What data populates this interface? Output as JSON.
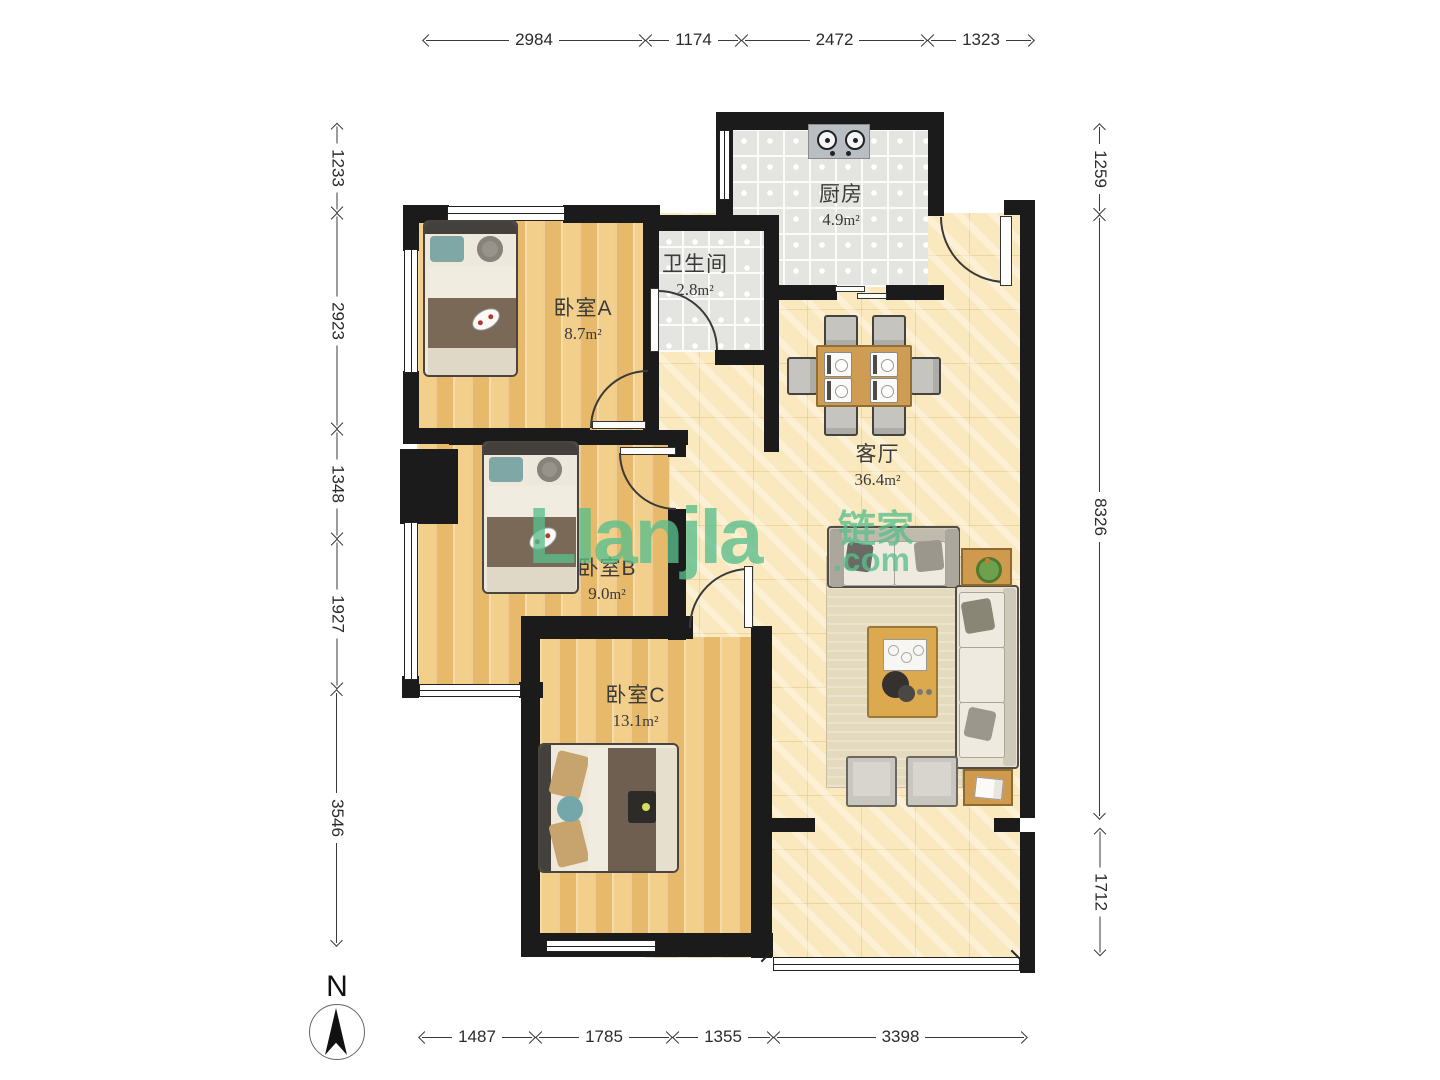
{
  "title": "户型图",
  "rooms": [
    {
      "id": "kitchen",
      "name": "厨房",
      "area": "4.9",
      "unit": "m²"
    },
    {
      "id": "bathroom",
      "name": "卫生间",
      "area": "2.8",
      "unit": "m²"
    },
    {
      "id": "bedroomA",
      "name": "卧室A",
      "area": "8.7",
      "unit": "m²"
    },
    {
      "id": "living",
      "name": "客厅",
      "area": "36.4",
      "unit": "m²"
    },
    {
      "id": "bedroomB",
      "name": "卧室B",
      "area": "9.0",
      "unit": "m²"
    },
    {
      "id": "bedroomC",
      "name": "卧室C",
      "area": "13.1",
      "unit": "m²"
    }
  ],
  "dimensions": {
    "top": [
      "2984",
      "1174",
      "2472",
      "1323"
    ],
    "bottom": [
      "1487",
      "1785",
      "1355",
      "3398"
    ],
    "left": [
      "1233",
      "2923",
      "1348",
      "1927",
      "3546"
    ],
    "right": [
      "1259",
      "8326",
      "1712"
    ]
  },
  "watermark": {
    "logo": "LIanjIa",
    "cn": "链家",
    "domain": ".com",
    "color": "#58be8c"
  },
  "compass": {
    "label": "N"
  },
  "colors": {
    "wall": "#1b1b1b",
    "wood_floor": "#eec77e",
    "tile_floor": "#e4e5e1",
    "living_floor": "#fae8be",
    "watermark_green": "#58be8c"
  }
}
